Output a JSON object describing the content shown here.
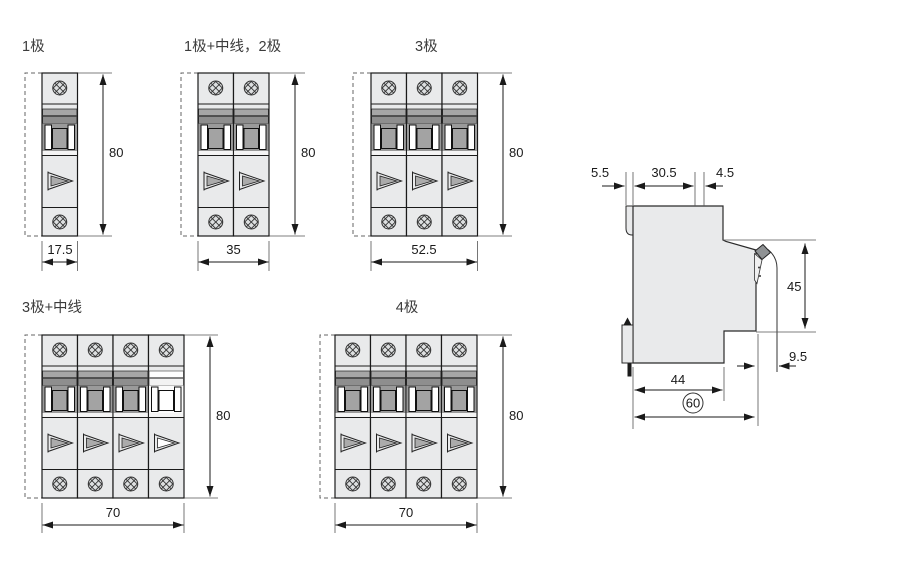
{
  "title": "MCB outline and mounting dimension drawing",
  "figures": [
    {
      "label": "1极",
      "modules": 1,
      "neutral_module": false,
      "dim_height": "80",
      "dim_width": "17.5"
    },
    {
      "label": "1极+中线，2极",
      "modules": 2,
      "neutral_module": false,
      "dim_height": "80",
      "dim_width": "35"
    },
    {
      "label": "3极",
      "modules": 3,
      "neutral_module": false,
      "dim_height": "80",
      "dim_width": "52.5"
    },
    {
      "label": "3极+中线",
      "modules": 4,
      "neutral_module": true,
      "dim_height": "80",
      "dim_width": "70"
    },
    {
      "label": "4极",
      "modules": 4,
      "neutral_module": false,
      "dim_height": "80",
      "dim_width": "70"
    }
  ],
  "side_view": {
    "dim_din_depth": "5.5",
    "dim_top_width": "30.5",
    "dim_front_step": "4.5",
    "dim_front_height": "45",
    "dim_lever": "9.5",
    "dim_base_width": "44",
    "dim_overall_depth": "60"
  },
  "colors": {
    "body_fill": "#e9eaeb",
    "band_gray": "#a6a6a6",
    "band_dark": "#8e8e8e",
    "toggle_gray": "#9a9a9a",
    "outline": "#1a1a1a"
  }
}
